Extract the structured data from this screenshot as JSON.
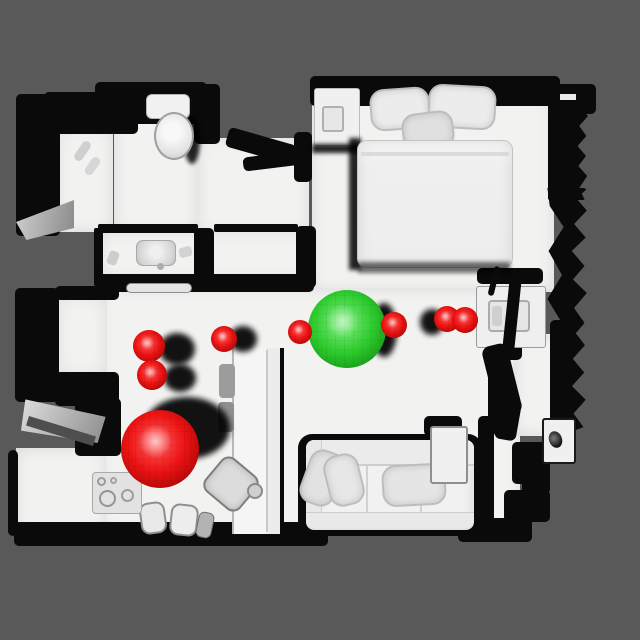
{
  "scene": {
    "description": "Top-down orthographic view of a 3D-scanned apartment mesh with sphere markers",
    "background_color": "#595959",
    "floor_color": "#f2f2f1",
    "wall_color": "#0a0a0a",
    "furniture_color": "#ececec",
    "marker_red_color": "#e51515",
    "marker_green_color": "#2ecc2e"
  },
  "rooms": [
    {
      "name": "bathroom"
    },
    {
      "name": "closet"
    },
    {
      "name": "hallway"
    },
    {
      "name": "bedroom"
    },
    {
      "name": "living-room"
    },
    {
      "name": "alcove"
    }
  ],
  "markers": {
    "target": {
      "name": "target-marker-green",
      "x": 347,
      "y": 329,
      "r": 39,
      "color": "green",
      "shadow": {
        "cx": 384,
        "cy": 330,
        "w": 26,
        "h": 54
      }
    },
    "waypoints": [
      {
        "name": "waypoint-red-large",
        "x": 160,
        "y": 449,
        "r": 39,
        "color": "red",
        "shadow": {
          "cx": 187,
          "cy": 428,
          "w": 86,
          "h": 62
        }
      },
      {
        "name": "waypoint-red-1",
        "x": 149,
        "y": 346,
        "r": 16,
        "color": "red",
        "shadow": {
          "cx": 177,
          "cy": 349,
          "w": 36,
          "h": 32
        }
      },
      {
        "name": "waypoint-red-2",
        "x": 152,
        "y": 375,
        "r": 15,
        "color": "red",
        "shadow": {
          "cx": 180,
          "cy": 378,
          "w": 32,
          "h": 28
        }
      },
      {
        "name": "waypoint-red-3",
        "x": 224,
        "y": 339,
        "r": 13,
        "color": "red",
        "shadow": {
          "cx": 243,
          "cy": 339,
          "w": 28,
          "h": 26
        }
      },
      {
        "name": "waypoint-red-4",
        "x": 300,
        "y": 332,
        "r": 12,
        "color": "red",
        "shadow": null
      },
      {
        "name": "waypoint-red-5",
        "x": 394,
        "y": 325,
        "r": 13,
        "color": "red",
        "shadow": null
      },
      {
        "name": "waypoint-red-6",
        "x": 447,
        "y": 319,
        "r": 13,
        "color": "red",
        "shadow": {
          "cx": 432,
          "cy": 322,
          "w": 24,
          "h": 26
        }
      },
      {
        "name": "waypoint-red-7",
        "x": 465,
        "y": 320,
        "r": 13,
        "color": "red",
        "shadow": null
      }
    ]
  }
}
